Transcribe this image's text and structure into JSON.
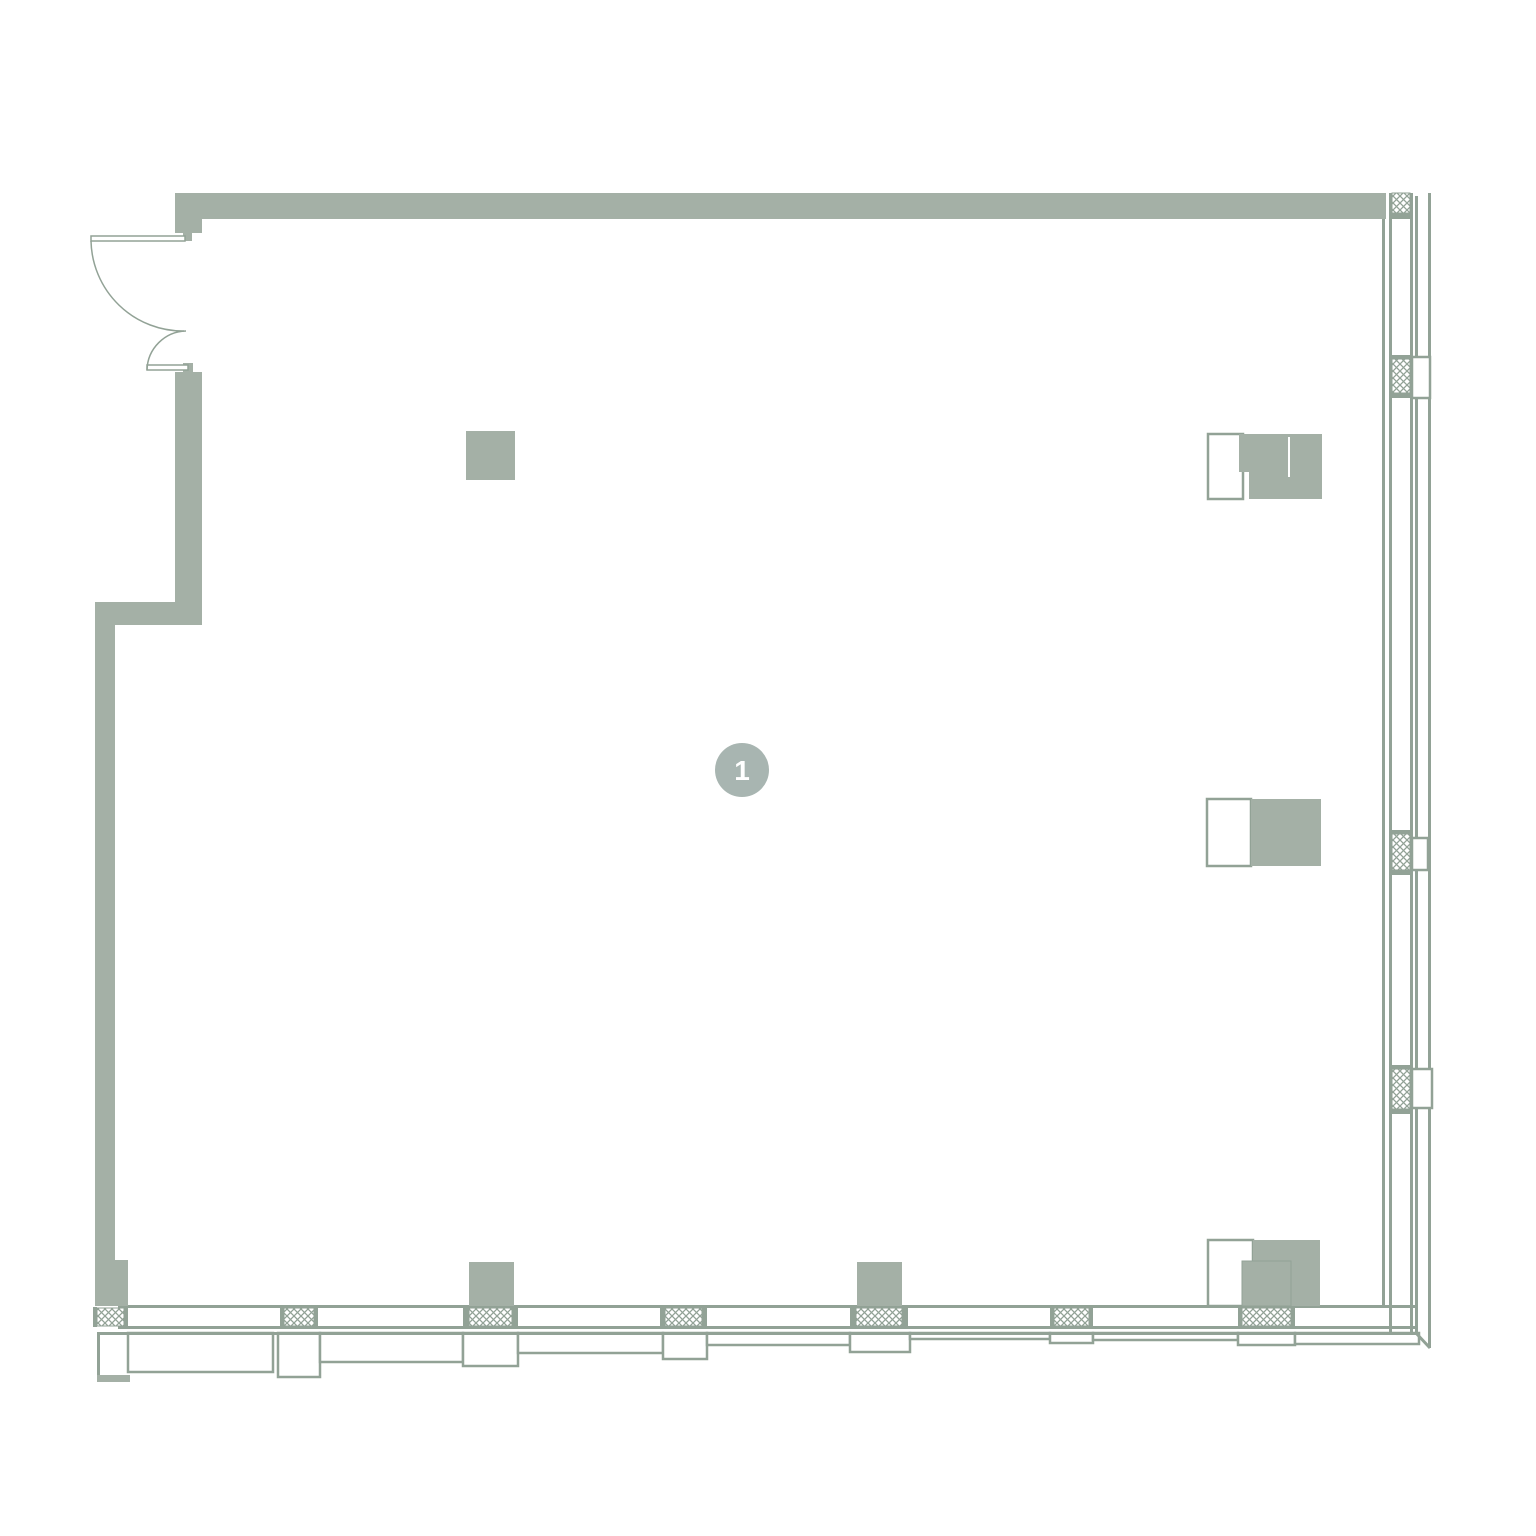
{
  "plan": {
    "title": "floor-plan-unit-1",
    "canvas": {
      "width": 1536,
      "height": 1536,
      "background": "#ffffff"
    },
    "colors": {
      "wall": "#a4b0a6",
      "line": "#92a296",
      "white": "#ffffff",
      "marker": "#a8b5b1",
      "marker_text": "#ffffff"
    },
    "marker": {
      "label": "1",
      "cx": 742,
      "cy": 770,
      "r": 27,
      "font_size": 28
    },
    "hatch": {
      "size": 7,
      "stroke_width": 1.3
    },
    "shapes": [
      {
        "n": "sill-panel-1",
        "t": "orect",
        "x": 128,
        "y": 1333,
        "w": 145,
        "h": 39
      },
      {
        "n": "sill-mullion-box-1",
        "t": "orect",
        "x": 278,
        "y": 1333,
        "w": 42,
        "h": 44
      },
      {
        "n": "sill-panel-2",
        "t": "orect",
        "x": 320,
        "y": 1333,
        "w": 143,
        "h": 29
      },
      {
        "n": "sill-mullion-box-2",
        "t": "orect",
        "x": 463,
        "y": 1333,
        "w": 55,
        "h": 33
      },
      {
        "n": "sill-panel-3",
        "t": "orect",
        "x": 518,
        "y": 1333,
        "w": 145,
        "h": 20
      },
      {
        "n": "sill-mullion-box-3",
        "t": "orect",
        "x": 663,
        "y": 1333,
        "w": 44,
        "h": 26
      },
      {
        "n": "sill-panel-4",
        "t": "orect",
        "x": 707,
        "y": 1333,
        "w": 143,
        "h": 12
      },
      {
        "n": "sill-mullion-box-4",
        "t": "orect",
        "x": 850,
        "y": 1333,
        "w": 60,
        "h": 19
      },
      {
        "n": "sill-panel-5",
        "t": "orect",
        "x": 910,
        "y": 1333,
        "w": 140,
        "h": 6
      },
      {
        "n": "sill-mullion-box-5",
        "t": "orect",
        "x": 1050,
        "y": 1333,
        "w": 43,
        "h": 10
      },
      {
        "n": "sill-panel-6",
        "t": "orect",
        "x": 1093,
        "y": 1333,
        "w": 145,
        "h": 7
      },
      {
        "n": "sill-mullion-box-6",
        "t": "orect",
        "x": 1238,
        "y": 1333,
        "w": 57,
        "h": 12
      },
      {
        "n": "sill-panel-7",
        "t": "orect",
        "x": 1295,
        "y": 1333,
        "w": 124,
        "h": 11
      },
      {
        "n": "bottom-window-line-inner",
        "t": "rect",
        "x": 118,
        "y": 1305,
        "w": 1297,
        "h": 3,
        "f": "line"
      },
      {
        "n": "bottom-window-line-mid",
        "t": "rect",
        "x": 118,
        "y": 1326,
        "w": 1297,
        "h": 3,
        "f": "line"
      },
      {
        "n": "bottom-window-line-outer",
        "t": "rect",
        "x": 97,
        "y": 1332,
        "w": 1320,
        "h": 3,
        "f": "line"
      },
      {
        "n": "corner-miter",
        "t": "path",
        "d": "M 1415 1332 L 1430 1348",
        "sw": 3
      },
      {
        "n": "left-base-edge-line",
        "t": "rect",
        "x": 97,
        "y": 1333,
        "w": 3,
        "h": 45,
        "f": "line"
      },
      {
        "n": "bottom-mullion-cap",
        "t": "rect",
        "x": 93,
        "y": 1307,
        "w": 4,
        "h": 20,
        "f": "line"
      },
      {
        "n": "bottom-mullion-hatch",
        "t": "hatch",
        "x": 97,
        "y": 1308,
        "w": 27,
        "h": 18
      },
      {
        "n": "bottom-mullion-cap",
        "t": "rect",
        "x": 124,
        "y": 1307,
        "w": 4,
        "h": 20,
        "f": "line"
      },
      {
        "n": "bottom-mullion-cap",
        "t": "rect",
        "x": 280,
        "y": 1307,
        "w": 4,
        "h": 20,
        "f": "line"
      },
      {
        "n": "bottom-mullion-hatch",
        "t": "hatch",
        "x": 284,
        "y": 1308,
        "w": 30,
        "h": 18
      },
      {
        "n": "bottom-mullion-cap",
        "t": "rect",
        "x": 314,
        "y": 1307,
        "w": 4,
        "h": 20,
        "f": "line"
      },
      {
        "n": "bottom-mullion-cap",
        "t": "rect",
        "x": 463,
        "y": 1307,
        "w": 6,
        "h": 20,
        "f": "line"
      },
      {
        "n": "bottom-mullion-hatch",
        "t": "hatch",
        "x": 469,
        "y": 1308,
        "w": 43,
        "h": 18
      },
      {
        "n": "bottom-mullion-cap",
        "t": "rect",
        "x": 512,
        "y": 1307,
        "w": 6,
        "h": 20,
        "f": "line"
      },
      {
        "n": "bottom-mullion-cap",
        "t": "rect",
        "x": 660,
        "y": 1307,
        "w": 5,
        "h": 20,
        "f": "line"
      },
      {
        "n": "bottom-mullion-hatch",
        "t": "hatch",
        "x": 665,
        "y": 1308,
        "w": 37,
        "h": 18
      },
      {
        "n": "bottom-mullion-cap",
        "t": "rect",
        "x": 702,
        "y": 1307,
        "w": 5,
        "h": 20,
        "f": "line"
      },
      {
        "n": "bottom-mullion-cap",
        "t": "rect",
        "x": 850,
        "y": 1307,
        "w": 6,
        "h": 20,
        "f": "line"
      },
      {
        "n": "bottom-mullion-hatch",
        "t": "hatch",
        "x": 856,
        "y": 1308,
        "w": 46,
        "h": 18
      },
      {
        "n": "bottom-mullion-cap",
        "t": "rect",
        "x": 902,
        "y": 1307,
        "w": 6,
        "h": 20,
        "f": "line"
      },
      {
        "n": "bottom-mullion-cap",
        "t": "rect",
        "x": 1050,
        "y": 1307,
        "w": 4,
        "h": 20,
        "f": "line"
      },
      {
        "n": "bottom-mullion-hatch",
        "t": "hatch",
        "x": 1054,
        "y": 1308,
        "w": 35,
        "h": 18
      },
      {
        "n": "bottom-mullion-cap",
        "t": "rect",
        "x": 1089,
        "y": 1307,
        "w": 4,
        "h": 20,
        "f": "line"
      },
      {
        "n": "bottom-mullion-cap",
        "t": "rect",
        "x": 1238,
        "y": 1307,
        "w": 4,
        "h": 20,
        "f": "line"
      },
      {
        "n": "bottom-mullion-hatch",
        "t": "hatch",
        "x": 1242,
        "y": 1308,
        "w": 49,
        "h": 18
      },
      {
        "n": "bottom-mullion-cap",
        "t": "rect",
        "x": 1291,
        "y": 1307,
        "w": 4,
        "h": 20,
        "f": "line"
      },
      {
        "n": "right-wall-inner-line",
        "t": "rect",
        "x": 1382,
        "y": 219,
        "w": 3,
        "h": 1087,
        "f": "line"
      },
      {
        "n": "right-glazing-line-left",
        "t": "rect",
        "x": 1389,
        "y": 193,
        "w": 3,
        "h": 1140,
        "f": "line"
      },
      {
        "n": "right-glazing-line-right",
        "t": "rect",
        "x": 1410,
        "y": 193,
        "w": 3,
        "h": 1140,
        "f": "line"
      },
      {
        "n": "right-facade-line-1",
        "t": "rect",
        "x": 1415,
        "y": 196,
        "w": 3,
        "h": 1137,
        "f": "line"
      },
      {
        "n": "right-facade-line-2",
        "t": "rect",
        "x": 1428,
        "y": 193,
        "w": 3,
        "h": 1155,
        "f": "line"
      },
      {
        "n": "right-mullion-hatch",
        "t": "hatch",
        "x": 1392,
        "y": 193,
        "w": 18,
        "h": 20
      },
      {
        "n": "right-mullion-cap",
        "t": "rect",
        "x": 1392,
        "y": 213,
        "w": 18,
        "h": 6,
        "f": "line"
      },
      {
        "n": "right-mullion-cap",
        "t": "rect",
        "x": 1392,
        "y": 355,
        "w": 18,
        "h": 4,
        "f": "line"
      },
      {
        "n": "right-mullion-hatch",
        "t": "hatch",
        "x": 1392,
        "y": 359,
        "w": 18,
        "h": 34
      },
      {
        "n": "right-mullion-cap",
        "t": "rect",
        "x": 1392,
        "y": 393,
        "w": 18,
        "h": 5,
        "f": "line"
      },
      {
        "n": "right-mullion-bracket",
        "t": "orect",
        "x": 1412,
        "y": 357,
        "w": 18,
        "h": 41
      },
      {
        "n": "right-mullion-cap",
        "t": "rect",
        "x": 1392,
        "y": 830,
        "w": 18,
        "h": 4,
        "f": "line"
      },
      {
        "n": "right-mullion-hatch",
        "t": "hatch",
        "x": 1392,
        "y": 834,
        "w": 18,
        "h": 36
      },
      {
        "n": "right-mullion-cap",
        "t": "rect",
        "x": 1392,
        "y": 870,
        "w": 18,
        "h": 5,
        "f": "line"
      },
      {
        "n": "right-mullion-bracket",
        "t": "orect",
        "x": 1412,
        "y": 838,
        "w": 16,
        "h": 32
      },
      {
        "n": "right-mullion-cap",
        "t": "rect",
        "x": 1392,
        "y": 1065,
        "w": 18,
        "h": 4,
        "f": "line"
      },
      {
        "n": "right-mullion-hatch",
        "t": "hatch",
        "x": 1392,
        "y": 1069,
        "w": 18,
        "h": 40
      },
      {
        "n": "right-mullion-cap",
        "t": "rect",
        "x": 1392,
        "y": 1109,
        "w": 18,
        "h": 5,
        "f": "line"
      },
      {
        "n": "right-mullion-bracket",
        "t": "orect",
        "x": 1412,
        "y": 1069,
        "w": 20,
        "h": 39
      },
      {
        "n": "top-wall",
        "t": "rect",
        "x": 175,
        "y": 193,
        "w": 1211,
        "h": 26,
        "f": "wall"
      },
      {
        "n": "top-wall-end-block",
        "t": "rect",
        "x": 175,
        "y": 193,
        "w": 27,
        "h": 40,
        "f": "wall"
      },
      {
        "n": "door-jamb-top",
        "t": "rect",
        "x": 183,
        "y": 230,
        "w": 9,
        "h": 11,
        "f": "wall"
      },
      {
        "n": "door-jamb-bottom",
        "t": "rect",
        "x": 183,
        "y": 363,
        "w": 10,
        "h": 9,
        "f": "wall"
      },
      {
        "n": "left-wall-upper",
        "t": "rect",
        "x": 175,
        "y": 372,
        "w": 27,
        "h": 253,
        "f": "wall"
      },
      {
        "n": "left-wall-jog",
        "t": "rect",
        "x": 95,
        "y": 602,
        "w": 107,
        "h": 23,
        "f": "wall"
      },
      {
        "n": "left-wall-lower",
        "t": "rect",
        "x": 95,
        "y": 625,
        "w": 20,
        "h": 677,
        "f": "wall"
      },
      {
        "n": "left-wall-base",
        "t": "rect",
        "x": 95,
        "y": 1260,
        "w": 33,
        "h": 46,
        "f": "wall"
      },
      {
        "n": "left-base-step",
        "t": "rect",
        "x": 97,
        "y": 1375,
        "w": 33,
        "h": 7,
        "f": "wall"
      },
      {
        "n": "column-1",
        "t": "rect",
        "x": 466,
        "y": 431,
        "w": 49,
        "h": 49,
        "f": "wall"
      },
      {
        "n": "column-2",
        "t": "rect",
        "x": 469,
        "y": 1262,
        "w": 45,
        "h": 44,
        "f": "wall"
      },
      {
        "n": "column-3",
        "t": "rect",
        "x": 857,
        "y": 1262,
        "w": 45,
        "h": 44,
        "f": "wall"
      },
      {
        "n": "cabinet-top-outline",
        "t": "orect",
        "x": 1208,
        "y": 434,
        "w": 35,
        "h": 65
      },
      {
        "n": "cabinet-top-fill-a",
        "t": "rect",
        "x": 1239,
        "y": 434,
        "w": 83,
        "h": 38,
        "f": "wall"
      },
      {
        "n": "cabinet-top-fill-b",
        "t": "rect",
        "x": 1249,
        "y": 472,
        "w": 73,
        "h": 27,
        "f": "wall"
      },
      {
        "n": "cabinet-top-seam",
        "t": "rect",
        "x": 1288,
        "y": 437,
        "w": 2,
        "h": 40,
        "f": "white"
      },
      {
        "n": "cabinet-mid-outline",
        "t": "orect",
        "x": 1207,
        "y": 799,
        "w": 44,
        "h": 67
      },
      {
        "n": "cabinet-mid-fill",
        "t": "rect",
        "x": 1251,
        "y": 799,
        "w": 70,
        "h": 67,
        "f": "wall"
      },
      {
        "n": "cabinet-bottom-outline",
        "t": "orect",
        "x": 1208,
        "y": 1240,
        "w": 45,
        "h": 66
      },
      {
        "n": "cabinet-bottom-fill",
        "t": "rect",
        "x": 1253,
        "y": 1240,
        "w": 67,
        "h": 66,
        "f": "wall"
      },
      {
        "n": "cabinet-bottom-inner",
        "t": "rect",
        "x": 1242,
        "y": 1261,
        "w": 49,
        "h": 45,
        "f": "wall",
        "s": "line",
        "sw": 1
      },
      {
        "n": "door-leaf-top",
        "t": "orect",
        "x": 91,
        "y": 236,
        "w": 94,
        "h": 5,
        "sw": 1.5
      },
      {
        "n": "door-swing-top",
        "t": "path",
        "d": "M 91 241 A 92 92 0 0 0 184 331",
        "sw": 1.5
      },
      {
        "n": "door-leaf-bottom",
        "t": "orect",
        "x": 147,
        "y": 365,
        "w": 41,
        "h": 5,
        "sw": 1.5
      },
      {
        "n": "door-swing-bottom",
        "t": "path",
        "d": "M 147 370 A 40 40 0 0 1 186 331",
        "sw": 1.5
      }
    ]
  }
}
